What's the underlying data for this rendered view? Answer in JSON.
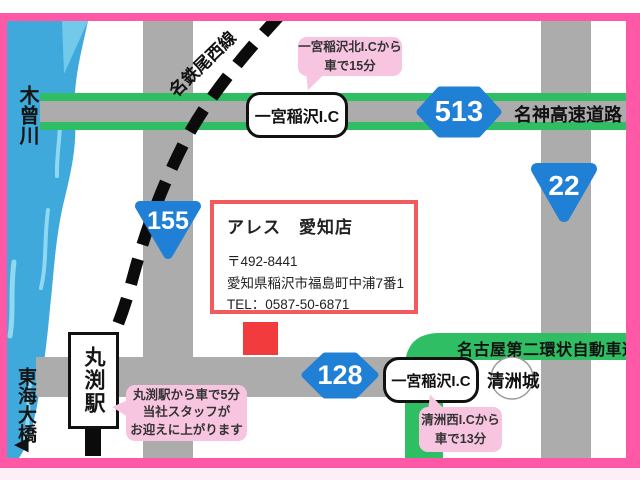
{
  "map": {
    "labels": {
      "river": "木曾川",
      "bridge": "東海大橋",
      "bridge_arrow": "◀",
      "rail_line": "名鉄尾西線",
      "station": "丸渕駅",
      "expressway": "名神高速道路",
      "ring_road": "名古屋第二環状自動車道",
      "castle": "清洲城",
      "ic_top": "一宮稲沢I.C",
      "ic_bottom": "一宮稲沢I.C"
    },
    "badges": {
      "b155": "155",
      "b22": "22",
      "b513": "513",
      "b128": "128"
    },
    "bubbles": {
      "top": {
        "line1": "一宮稲沢北I.Cから",
        "line2": "車で15分"
      },
      "right": {
        "line1": "清洲西I.Cから",
        "line2": "車で13分"
      },
      "left": {
        "line1": "丸渕駅から車で5分",
        "line2": "当社スタッフが",
        "line3": "お迎えに上がります"
      }
    },
    "info_box": {
      "title": "アレス　愛知店",
      "postal": "〒492-8441",
      "address": "愛知県稲沢市福島町中浦7番1",
      "tel": "TEL：0587-50-6871"
    },
    "colors": {
      "frame_pink": "#FF58A7",
      "bubble_pink": "#F8C5E0",
      "road_gray": "#ACACAC",
      "highway_green": "#2FBE63",
      "badge_blue": "#2080D6",
      "river_blue": "#3FA9DC",
      "river_highlight": "#8FD8F2",
      "marker_red": "#F23B3C",
      "info_border_red": "#F15B5E"
    }
  }
}
